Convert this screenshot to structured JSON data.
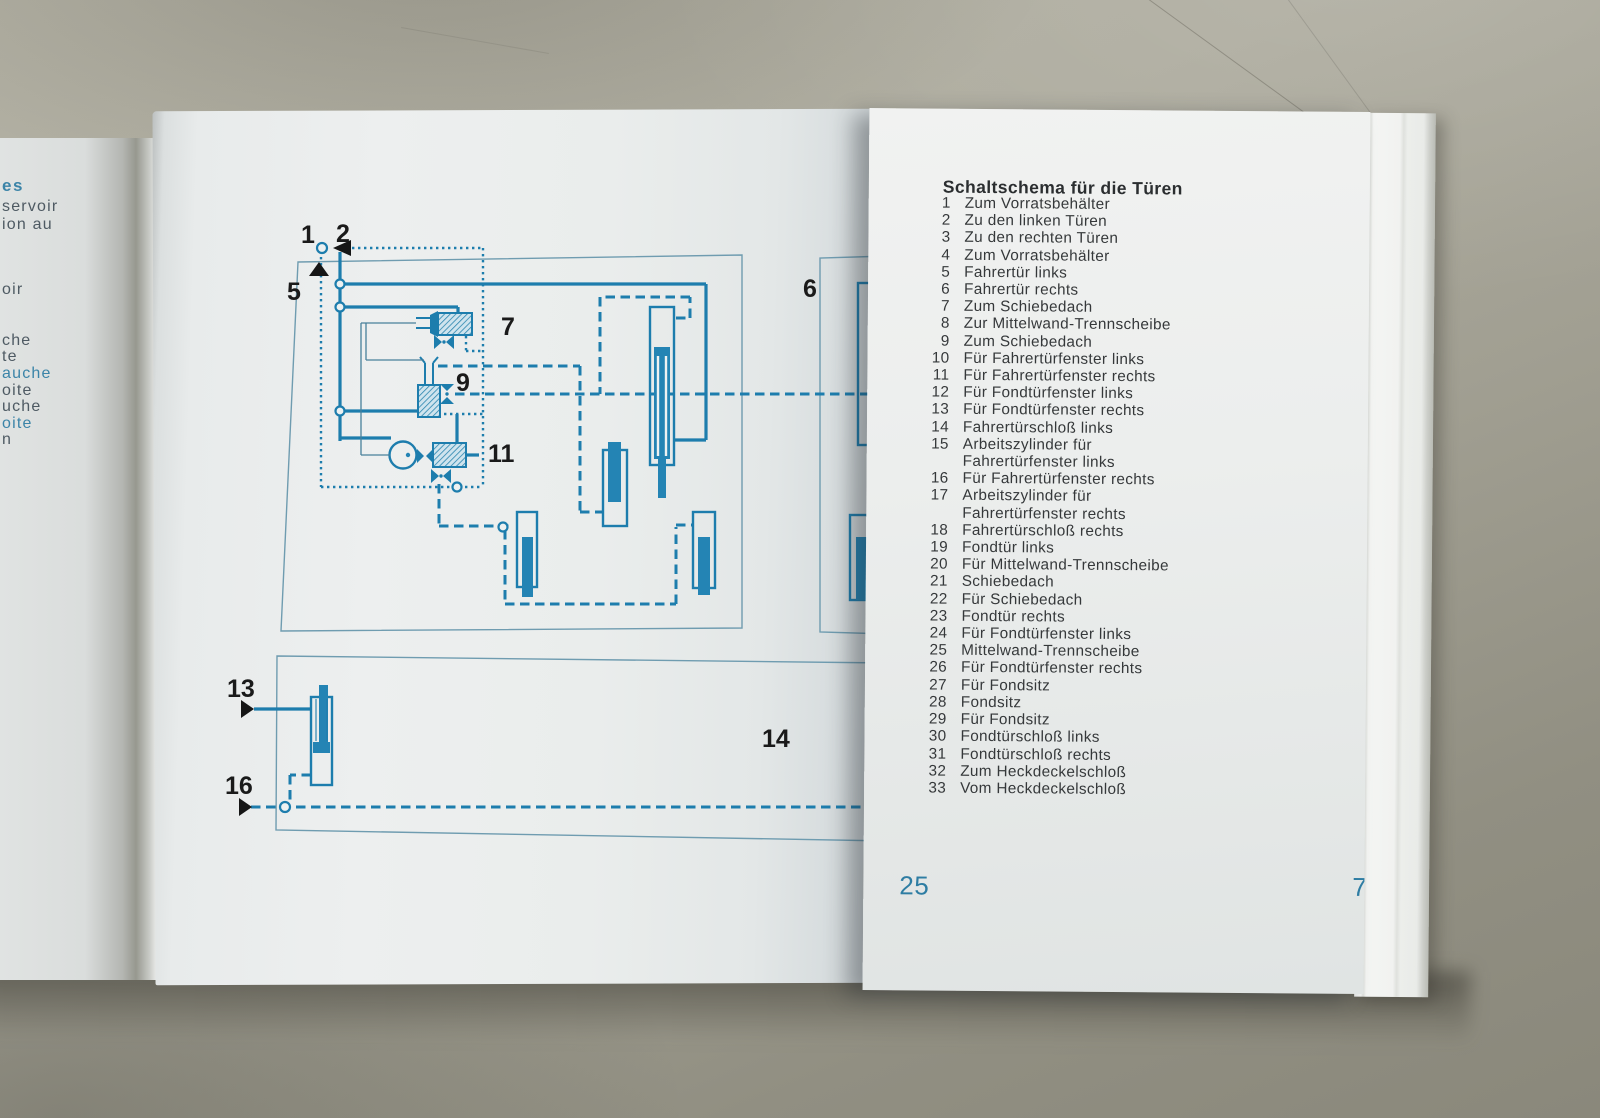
{
  "colors": {
    "diagram_teal": "#1d7dad",
    "rod_blue": "#2484b4",
    "thin_outline": "#6f9cb0",
    "page_number_teal": "#2e7da3",
    "label_black": "#1a1a1a"
  },
  "left_page": {
    "diagram": {
      "labels": {
        "n1": "1",
        "n2": "2",
        "n5": "5",
        "n6": "6",
        "n7": "7",
        "n9": "9",
        "n11": "11",
        "n13": "13",
        "n14": "14",
        "n16": "16"
      }
    }
  },
  "previous_page_fragments": [
    {
      "text": "es",
      "tone": "teal"
    },
    {
      "text": "servoir",
      "tone": "dark"
    },
    {
      "text": "ion au",
      "tone": "dark"
    },
    {
      "text": "oir",
      "tone": "dark"
    },
    {
      "text": "che",
      "tone": "dark"
    },
    {
      "text": "te",
      "tone": "dark"
    },
    {
      "text": "auche",
      "tone": "teal"
    },
    {
      "text": "oite",
      "tone": "dark"
    },
    {
      "text": "uche",
      "tone": "dark"
    },
    {
      "text": "oite",
      "tone": "teal"
    },
    {
      "text": "n",
      "tone": "dark"
    }
  ],
  "right_page": {
    "heading": "Schaltschema für die Türen",
    "legend": [
      {
        "num": "1",
        "text": "Zum Vorratsbehälter"
      },
      {
        "num": "2",
        "text": "Zu den linken Türen"
      },
      {
        "num": "3",
        "text": "Zu den rechten Türen"
      },
      {
        "num": "4",
        "text": "Zum Vorratsbehälter"
      },
      {
        "num": "5",
        "text": "Fahrertür links"
      },
      {
        "num": "6",
        "text": "Fahrertür rechts"
      },
      {
        "num": "7",
        "text": "Zum Schiebedach"
      },
      {
        "num": "8",
        "text": "Zur Mittelwand-Trennscheibe"
      },
      {
        "num": "9",
        "text": "Zum Schiebedach"
      },
      {
        "num": "10",
        "text": "Für Fahrertürfenster links"
      },
      {
        "num": "11",
        "text": "Für Fahrertürfenster rechts"
      },
      {
        "num": "12",
        "text": "Für Fondtürfenster links"
      },
      {
        "num": "13",
        "text": "Für Fondtürfenster rechts"
      },
      {
        "num": "14",
        "text": "Fahrertürschloß links"
      },
      {
        "num": "15",
        "text": "Arbeitszylinder für",
        "text2": "Fahrertürfenster links"
      },
      {
        "num": "16",
        "text": "Für Fahrertürfenster rechts"
      },
      {
        "num": "17",
        "text": "Arbeitszylinder für",
        "text2": "Fahrertürfenster rechts"
      },
      {
        "num": "18",
        "text": "Fahrertürschloß rechts"
      },
      {
        "num": "19",
        "text": "Fondtür links"
      },
      {
        "num": "20",
        "text": "Für Mittelwand-Trennscheibe"
      },
      {
        "num": "21",
        "text": "Schiebedach"
      },
      {
        "num": "22",
        "text": "Für Schiebedach"
      },
      {
        "num": "23",
        "text": "Fondtür rechts"
      },
      {
        "num": "24",
        "text": "Für Fondtürfenster links"
      },
      {
        "num": "25",
        "text": "Mittelwand-Trennscheibe"
      },
      {
        "num": "26",
        "text": "Für Fondtürfenster rechts"
      },
      {
        "num": "27",
        "text": "Für Fondsitz"
      },
      {
        "num": "28",
        "text": "Fondsitz"
      },
      {
        "num": "29",
        "text": "Für Fondsitz"
      },
      {
        "num": "30",
        "text": "Fondtürschloß links"
      },
      {
        "num": "31",
        "text": "Fondtürschloß rechts"
      },
      {
        "num": "32",
        "text": "Zum Heckdeckelschloß"
      },
      {
        "num": "33",
        "text": "Vom Heckdeckelschloß"
      }
    ],
    "page_number": "25",
    "facing_page_number": "7"
  }
}
